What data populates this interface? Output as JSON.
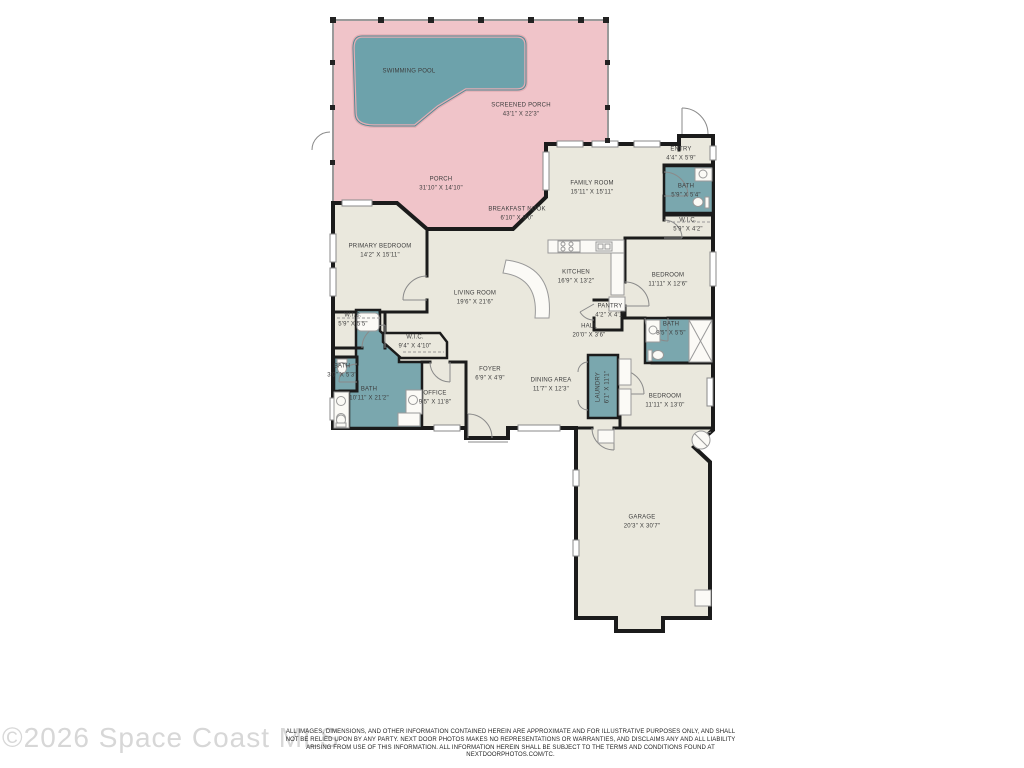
{
  "colors": {
    "porch_pink": "#f0c4c9",
    "pool_teal": "#6da2ab",
    "bath_teal": "#7aa7ae",
    "floor_beige": "#eae8dd",
    "wall_black": "#1b1b1b"
  },
  "floorplan": {
    "rooms": [
      {
        "id": "swimming-pool",
        "name": "SWIMMING POOL",
        "dims": ""
      },
      {
        "id": "screened-porch",
        "name": "SCREENED PORCH",
        "dims": "43'1\" X 22'3\""
      },
      {
        "id": "porch",
        "name": "PORCH",
        "dims": "31'10\" X 14'10\""
      },
      {
        "id": "family-room",
        "name": "FAMILY ROOM",
        "dims": "15'11\" X 15'11\""
      },
      {
        "id": "entry",
        "name": "ENTRY",
        "dims": "4'4\" X 5'9\""
      },
      {
        "id": "bath-entry",
        "name": "BATH",
        "dims": "5'9\" X 5'4\""
      },
      {
        "id": "wic-entry",
        "name": "W.I.C.",
        "dims": "5'9\" X 4'2\""
      },
      {
        "id": "breakfast-nook",
        "name": "BREAKFAST NOOK",
        "dims": "6'10\" X 9'0\""
      },
      {
        "id": "primary-bedroom",
        "name": "PRIMARY BEDROOM",
        "dims": "14'2\" X 15'11\""
      },
      {
        "id": "kitchen",
        "name": "KITCHEN",
        "dims": "16'9\" X 13'2\""
      },
      {
        "id": "bedroom-front",
        "name": "BEDROOM",
        "dims": "11'11\" X 12'6\""
      },
      {
        "id": "living-room",
        "name": "LIVING ROOM",
        "dims": "19'6\" X 21'6\""
      },
      {
        "id": "pantry",
        "name": "PANTRY",
        "dims": "4'2\" X 4'1\""
      },
      {
        "id": "hall",
        "name": "HALL",
        "dims": "20'0\" X 3'6\""
      },
      {
        "id": "bath-hall",
        "name": "BATH",
        "dims": "8'5\" X 5'5\""
      },
      {
        "id": "wic-primary-1",
        "name": "W.I.C.",
        "dims": "5'9\" X 5'5\""
      },
      {
        "id": "wic-primary-2",
        "name": "W.I.C.",
        "dims": "9'4\" X 4'10\""
      },
      {
        "id": "bath-small",
        "name": "BATH",
        "dims": "3'0\" X 5'3\""
      },
      {
        "id": "bath-primary",
        "name": "BATH",
        "dims": "10'11\" X 21'2\""
      },
      {
        "id": "foyer",
        "name": "FOYER",
        "dims": "6'9\" X 4'9\""
      },
      {
        "id": "dining-area",
        "name": "DINING AREA",
        "dims": "11'7\" X 12'3\""
      },
      {
        "id": "laundry",
        "name": "LAUNDRY",
        "dims": "6'1\" X 11'1\""
      },
      {
        "id": "office",
        "name": "OFFICE",
        "dims": "9'5\" X 11'8\""
      },
      {
        "id": "bedroom-back",
        "name": "BEDROOM",
        "dims": "11'11\" X 13'0\""
      },
      {
        "id": "garage",
        "name": "GARAGE",
        "dims": "20'3\" X 30'7\""
      }
    ]
  },
  "footer": {
    "watermark": "©2026 Space Coast MLS",
    "disclaimer": "ALL IMAGES, DIMENSIONS, AND OTHER INFORMATION CONTAINED HEREIN ARE APPROXIMATE AND FOR ILLUSTRATIVE PURPOSES ONLY, AND SHALL NOT BE RELIED UPON BY ANY PARTY. NEXT DOOR PHOTOS MAKES NO REPRESENTATIONS OR WARRANTIES, AND DISCLAIMS ANY AND ALL LIABILITY ARISING FROM USE OF THIS INFORMATION. ALL INFORMATION HEREIN SHALL BE SUBJECT TO THE TERMS AND CONDITIONS FOUND AT NEXTDOORPHOTOS.COM/TC."
  }
}
